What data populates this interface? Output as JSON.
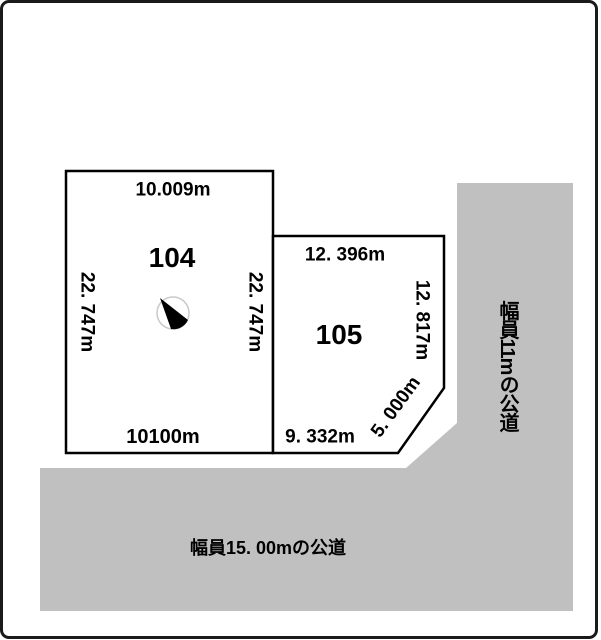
{
  "diagram_title": "land-plot-survey-diagram",
  "colors": {
    "road_fill": "#c0c0c0",
    "lot_fill": "#ffffff",
    "line": "#000000",
    "background": "#ffffff",
    "compass_ring": "#c9c9c9"
  },
  "lots": [
    {
      "id": "104",
      "top_dim": "10.009m",
      "left_dim": "22. 747m",
      "right_dim": "22. 747m",
      "bottom_dim": "10100m"
    },
    {
      "id": "105",
      "top_dim": "12. 396m",
      "right_dim": "12. 817m",
      "bottom_dim": "9. 332m",
      "chamfer_dim": "5. 000m"
    }
  ],
  "roads": [
    {
      "side": "right",
      "label": "幅員11mの公道"
    },
    {
      "side": "bottom",
      "label": "幅員15. 00mの公道"
    }
  ],
  "icons": {
    "north_arrow": "compass-needle"
  }
}
